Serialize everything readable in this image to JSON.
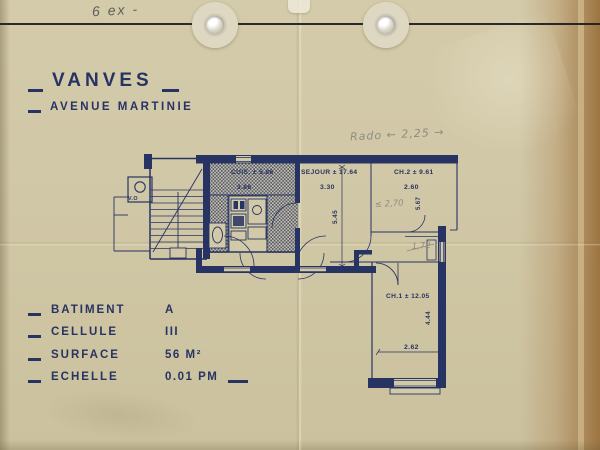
{
  "colors": {
    "paper": "#d1c8a7",
    "ink": "#273362",
    "pencil": "#8d8c82",
    "fastener_line": "#1b1b22"
  },
  "annotations": {
    "copies_note": "6 ex -",
    "pencil_top_note": "Rado ← 2,25 →",
    "pencil_ch2_width": "≤ 2,70",
    "pencil_wc_width": "1,72"
  },
  "title": {
    "city": "VANVES",
    "street": "AVENUE MARTINIE"
  },
  "specs": {
    "rows": [
      {
        "label": "BATIMENT",
        "value": "A"
      },
      {
        "label": "CELLULE",
        "value": "III"
      },
      {
        "label": "SURFACE",
        "value": "56 M²"
      },
      {
        "label": "ECHELLE",
        "value": "0.01 PM"
      }
    ]
  },
  "plan": {
    "kitchen": {
      "area": "CUIS. ± 5.86",
      "width": "3.88"
    },
    "sejour": {
      "area": "SEJOUR ± 17.64",
      "width": "3.30",
      "depth": "5.45"
    },
    "bedroom2": {
      "area": "CH.2 ± 9.61",
      "width": "2.60",
      "side": "5.67"
    },
    "bedroom1": {
      "area": "CH.1 ± 12.05",
      "depth": "4.44",
      "width": "2.62"
    },
    "chute": {
      "label": "V.O"
    }
  }
}
